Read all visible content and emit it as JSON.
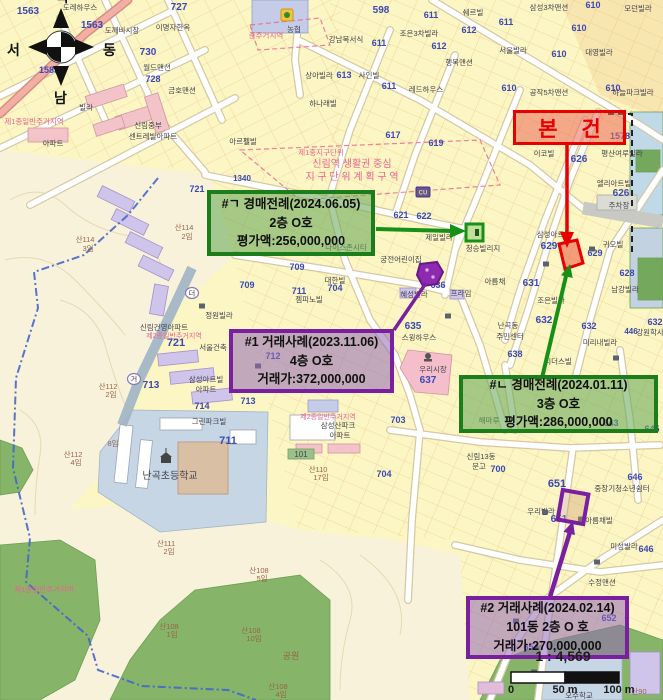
{
  "compass": {
    "north": "북",
    "south": "남",
    "west": "서",
    "east": "동"
  },
  "scale_bar": {
    "ratio_label": "1 : 4,569",
    "ticks": [
      "0",
      "50 m",
      "100 m"
    ]
  },
  "annotations": {
    "subject": {
      "label": "본 건",
      "color": "#e80000"
    },
    "auction_1": {
      "title": "#ㄱ 경매전례(2024.06.05)",
      "floor": "2층 O호",
      "value": "평가액:256,000,000",
      "color": "#1b7e1b"
    },
    "sale_1": {
      "title": "#1 거래사례(2023.11.06)",
      "floor": "4층 O호",
      "value": "거래가:372,000,000",
      "color": "#7a1fa0"
    },
    "auction_2": {
      "title": "#ㄴ 경매전례(2024.01.11)",
      "floor": "3층 O호",
      "value": "평가액:286,000,000",
      "color": "#1b7e1b"
    },
    "sale_2": {
      "title": "#2 거래사례(2024.02.14)",
      "floor": "101동 2층 O 호",
      "value": "거래가:270,000,000",
      "color": "#7a1fa0"
    }
  },
  "map": {
    "label_colors": {
      "b": "#3b49b5",
      "d": "#43434e",
      "p": "#e8638f",
      "m": "#96664a"
    },
    "labels": [
      {
        "t": "1563",
        "x": 28,
        "y": 14,
        "c": "b",
        "s": 10
      },
      {
        "t": "도레하우스",
        "x": 80,
        "y": 10,
        "c": "d"
      },
      {
        "t": "1563",
        "x": 92,
        "y": 28,
        "c": "b",
        "s": 10
      },
      {
        "t": "도깨비시장",
        "x": 122,
        "y": 33,
        "c": "d"
      },
      {
        "t": "727",
        "x": 179,
        "y": 10,
        "c": "b",
        "s": 10
      },
      {
        "t": "이명자한옥",
        "x": 173,
        "y": 30,
        "c": "d"
      },
      {
        "t": "730",
        "x": 148,
        "y": 55,
        "c": "b",
        "s": 10
      },
      {
        "t": "월드맨션",
        "x": 157,
        "y": 70,
        "c": "d"
      },
      {
        "t": "728",
        "x": 153,
        "y": 82,
        "c": "b",
        "s": 9
      },
      {
        "t": "금호맨션",
        "x": 182,
        "y": 93,
        "c": "d"
      },
      {
        "t": "1583",
        "x": 49,
        "y": 73,
        "c": "b",
        "s": 9
      },
      {
        "t": "빌라",
        "x": 86,
        "y": 110,
        "c": "d"
      },
      {
        "t": "제1종일반주거지역",
        "x": 34,
        "y": 124,
        "c": "p"
      },
      {
        "t": "신림중부",
        "x": 148,
        "y": 128,
        "c": "d"
      },
      {
        "t": "센트레빌아파트",
        "x": 153,
        "y": 139,
        "c": "d"
      },
      {
        "t": "아파트",
        "x": 53,
        "y": 146,
        "c": "d"
      },
      {
        "t": "농협",
        "x": 294,
        "y": 32,
        "c": "d"
      },
      {
        "t": "준주거지역",
        "x": 266,
        "y": 38,
        "c": "p"
      },
      {
        "t": "598",
        "x": 381,
        "y": 13,
        "c": "b",
        "s": 10
      },
      {
        "t": "611",
        "x": 431,
        "y": 18,
        "c": "b",
        "s": 9
      },
      {
        "t": "쉐르빌",
        "x": 473,
        "y": 15,
        "c": "d"
      },
      {
        "t": "삼성3차맨션",
        "x": 549,
        "y": 10,
        "c": "d"
      },
      {
        "t": "610",
        "x": 593,
        "y": 8,
        "c": "b",
        "s": 9
      },
      {
        "t": "모던빌라",
        "x": 638,
        "y": 11,
        "c": "d"
      },
      {
        "t": "강남복서식",
        "x": 346,
        "y": 42,
        "c": "d"
      },
      {
        "t": "611",
        "x": 379,
        "y": 46,
        "c": "b",
        "s": 9
      },
      {
        "t": "조은3차빌라",
        "x": 419,
        "y": 36,
        "c": "d"
      },
      {
        "t": "612",
        "x": 469,
        "y": 33,
        "c": "b",
        "s": 9
      },
      {
        "t": "611",
        "x": 506,
        "y": 25,
        "c": "b",
        "s": 9
      },
      {
        "t": "612",
        "x": 439,
        "y": 49,
        "c": "b",
        "s": 9
      },
      {
        "t": "서울빌라",
        "x": 513,
        "y": 53,
        "c": "d"
      },
      {
        "t": "610",
        "x": 579,
        "y": 31,
        "c": "b",
        "s": 9
      },
      {
        "t": "대영빌라",
        "x": 599,
        "y": 55,
        "c": "d"
      },
      {
        "t": "610",
        "x": 559,
        "y": 57,
        "c": "b",
        "s": 9
      },
      {
        "t": "행복맨션",
        "x": 459,
        "y": 65,
        "c": "d"
      },
      {
        "t": "613",
        "x": 344,
        "y": 78,
        "c": "b",
        "s": 9
      },
      {
        "t": "사인빌",
        "x": 369,
        "y": 78,
        "c": "d"
      },
      {
        "t": "상아빌라",
        "x": 319,
        "y": 78,
        "c": "d"
      },
      {
        "t": "611",
        "x": 389,
        "y": 89,
        "c": "b",
        "s": 9
      },
      {
        "t": "레드하우스",
        "x": 426,
        "y": 92,
        "c": "d"
      },
      {
        "t": "610",
        "x": 509,
        "y": 91,
        "c": "b",
        "s": 9
      },
      {
        "t": "공작5차맨션",
        "x": 549,
        "y": 95,
        "c": "d"
      },
      {
        "t": "610",
        "x": 613,
        "y": 91,
        "c": "b",
        "s": 9
      },
      {
        "t": "하늘파크빌라",
        "x": 633,
        "y": 95,
        "c": "d"
      },
      {
        "t": "하나래빌",
        "x": 323,
        "y": 106,
        "c": "d"
      },
      {
        "t": "제1종지구단위",
        "x": 321,
        "y": 155,
        "c": "p"
      },
      {
        "t": "신림역 생활권 중심",
        "x": 352,
        "y": 167,
        "c": "p",
        "s": 10
      },
      {
        "t": "지 구 단 위 계 획 구 역",
        "x": 352,
        "y": 180,
        "c": "p",
        "s": 10
      },
      {
        "t": "617",
        "x": 393,
        "y": 138,
        "c": "b",
        "s": 9
      },
      {
        "t": "619",
        "x": 436,
        "y": 146,
        "c": "b",
        "s": 9
      },
      {
        "t": "아르펠빌",
        "x": 243,
        "y": 144,
        "c": "d"
      },
      {
        "t": "1340",
        "x": 242,
        "y": 181,
        "c": "b",
        "s": 8
      },
      {
        "t": "621",
        "x": 401,
        "y": 218,
        "c": "b",
        "s": 9
      },
      {
        "t": "622",
        "x": 424,
        "y": 219,
        "c": "b",
        "s": 9
      },
      {
        "t": "제일빌라",
        "x": 439,
        "y": 240,
        "c": "d"
      },
      {
        "t": "청승빌리지",
        "x": 483,
        "y": 251,
        "c": "d"
      },
      {
        "t": "이코빌",
        "x": 544,
        "y": 156,
        "c": "d"
      },
      {
        "t": "1578",
        "x": 620,
        "y": 139,
        "c": "b",
        "s": 9
      },
      {
        "t": "평산여루빌라",
        "x": 622,
        "y": 156,
        "c": "d"
      },
      {
        "t": "626",
        "x": 579,
        "y": 162,
        "c": "b",
        "s": 10
      },
      {
        "t": "엘리아트빌",
        "x": 614,
        "y": 186,
        "c": "d"
      },
      {
        "t": "626",
        "x": 621,
        "y": 196,
        "c": "b",
        "s": 10
      },
      {
        "t": "주차장",
        "x": 619,
        "y": 208,
        "c": "d"
      },
      {
        "t": "삼성아트빌",
        "x": 554,
        "y": 237,
        "c": "d"
      },
      {
        "t": "629",
        "x": 549,
        "y": 249,
        "c": "b",
        "s": 10
      },
      {
        "t": "귀오빌",
        "x": 613,
        "y": 247,
        "c": "d"
      },
      {
        "t": "629",
        "x": 595,
        "y": 256,
        "c": "b",
        "s": 9
      },
      {
        "t": "628",
        "x": 627,
        "y": 276,
        "c": "b",
        "s": 9
      },
      {
        "t": "631",
        "x": 531,
        "y": 286,
        "c": "b",
        "s": 10
      },
      {
        "t": "남강빌라",
        "x": 625,
        "y": 292,
        "c": "d"
      },
      {
        "t": "조은빌라",
        "x": 551,
        "y": 303,
        "c": "d"
      },
      {
        "t": "632",
        "x": 544,
        "y": 323,
        "c": "b",
        "s": 10
      },
      {
        "t": "632",
        "x": 589,
        "y": 329,
        "c": "b",
        "s": 9
      },
      {
        "t": "632",
        "x": 655,
        "y": 325,
        "c": "b",
        "s": 9
      },
      {
        "t": "446",
        "x": 631,
        "y": 334,
        "c": "b",
        "s": 8
      },
      {
        "t": "강원학사",
        "x": 650,
        "y": 335,
        "c": "d"
      },
      {
        "t": "미리내빌라",
        "x": 600,
        "y": 345,
        "c": "d"
      },
      {
        "t": "리더스빌",
        "x": 558,
        "y": 364,
        "c": "d"
      },
      {
        "t": "721",
        "x": 197,
        "y": 192,
        "c": "b",
        "s": 9
      },
      {
        "t": "궁전어린이집",
        "x": 401,
        "y": 262,
        "c": "d"
      },
      {
        "t": "나이스존시티",
        "x": 346,
        "y": 250,
        "c": "d"
      },
      {
        "t": "709",
        "x": 297,
        "y": 270,
        "c": "b",
        "s": 9
      },
      {
        "t": "709",
        "x": 247,
        "y": 288,
        "c": "b",
        "s": 9
      },
      {
        "t": "711",
        "x": 299,
        "y": 294,
        "c": "b",
        "s": 9
      },
      {
        "t": "704",
        "x": 335,
        "y": 291,
        "c": "b",
        "s": 9
      },
      {
        "t": "대한빌",
        "x": 335,
        "y": 283,
        "c": "d"
      },
      {
        "t": "젬피노빌",
        "x": 309,
        "y": 302,
        "c": "d"
      },
      {
        "t": "정원빌라",
        "x": 219,
        "y": 318,
        "c": "d"
      },
      {
        "t": "신림건영아파트",
        "x": 164,
        "y": 330,
        "c": "d"
      },
      {
        "t": "제2종일반주거지역",
        "x": 174,
        "y": 338,
        "c": "p",
        "s": 7
      },
      {
        "t": "721",
        "x": 176,
        "y": 346,
        "c": "b",
        "s": 11
      },
      {
        "t": "서울건축",
        "x": 213,
        "y": 350,
        "c": "d"
      },
      {
        "t": "712",
        "x": 273,
        "y": 359,
        "c": "b",
        "s": 9
      },
      {
        "t": "삼성아트빌",
        "x": 206,
        "y": 382,
        "c": "d"
      },
      {
        "t": "아파트",
        "x": 206,
        "y": 392,
        "c": "d"
      },
      {
        "t": "713",
        "x": 151,
        "y": 388,
        "c": "b",
        "s": 10
      },
      {
        "t": "산114",
        "x": 85,
        "y": 242,
        "c": "m"
      },
      {
        "t": "3임",
        "x": 88,
        "y": 251,
        "c": "m"
      },
      {
        "t": "산114",
        "x": 184,
        "y": 230,
        "c": "m"
      },
      {
        "t": "2임",
        "x": 187,
        "y": 239,
        "c": "m"
      },
      {
        "t": "산112",
        "x": 108,
        "y": 389,
        "c": "m"
      },
      {
        "t": "2임",
        "x": 111,
        "y": 397,
        "c": "m"
      },
      {
        "t": "산112",
        "x": 73,
        "y": 457,
        "c": "m"
      },
      {
        "t": "4임",
        "x": 76,
        "y": 465,
        "c": "m"
      },
      {
        "t": "8임",
        "x": 113,
        "y": 446,
        "c": "m"
      },
      {
        "t": "714",
        "x": 202,
        "y": 409,
        "c": "b",
        "s": 9
      },
      {
        "t": "713",
        "x": 248,
        "y": 404,
        "c": "b",
        "s": 9
      },
      {
        "t": "그린파크빌",
        "x": 209,
        "y": 424,
        "c": "d"
      },
      {
        "t": "711",
        "x": 228,
        "y": 444,
        "c": "b",
        "s": 11
      },
      {
        "t": "난곡초등학교",
        "x": 170,
        "y": 479,
        "c": "d",
        "s": 10
      },
      {
        "t": "101",
        "x": 301,
        "y": 457,
        "c": "d",
        "s": 8
      },
      {
        "t": "산110",
        "x": 318,
        "y": 472,
        "c": "m"
      },
      {
        "t": "17임",
        "x": 321,
        "y": 480,
        "c": "m"
      },
      {
        "t": "제2종일반주거지역",
        "x": 328,
        "y": 419,
        "c": "p",
        "s": 7
      },
      {
        "t": "삼성산파크",
        "x": 338,
        "y": 428,
        "c": "d"
      },
      {
        "t": "아파트",
        "x": 340,
        "y": 438,
        "c": "d"
      },
      {
        "t": "703",
        "x": 398,
        "y": 423,
        "c": "b",
        "s": 9
      },
      {
        "t": "해마루",
        "x": 489,
        "y": 423,
        "c": "d"
      },
      {
        "t": "신림13동",
        "x": 481,
        "y": 459,
        "c": "d"
      },
      {
        "t": "문고",
        "x": 479,
        "y": 469,
        "c": "d"
      },
      {
        "t": "700",
        "x": 498,
        "y": 472,
        "c": "b",
        "s": 9
      },
      {
        "t": "704",
        "x": 384,
        "y": 477,
        "c": "b",
        "s": 9
      },
      {
        "t": "635",
        "x": 413,
        "y": 329,
        "c": "b",
        "s": 10
      },
      {
        "t": "스윙하우스",
        "x": 419,
        "y": 340,
        "c": "d"
      },
      {
        "t": "난곡동",
        "x": 508,
        "y": 328,
        "c": "d"
      },
      {
        "t": "주민센터",
        "x": 510,
        "y": 339,
        "c": "d"
      },
      {
        "t": "638",
        "x": 515,
        "y": 357,
        "c": "b",
        "s": 9
      },
      {
        "t": "우리시장",
        "x": 433,
        "y": 372,
        "c": "d"
      },
      {
        "t": "637",
        "x": 428,
        "y": 383,
        "c": "b",
        "s": 10
      },
      {
        "t": "636",
        "x": 438,
        "y": 288,
        "c": "b",
        "s": 9
      },
      {
        "t": "혜성빌라",
        "x": 414,
        "y": 297,
        "c": "d"
      },
      {
        "t": "프라임",
        "x": 461,
        "y": 296,
        "c": "d"
      },
      {
        "t": "아름채",
        "x": 495,
        "y": 284,
        "c": "d"
      },
      {
        "t": "643",
        "x": 611,
        "y": 426,
        "c": "b",
        "s": 9
      },
      {
        "t": "645",
        "x": 652,
        "y": 432,
        "c": "b",
        "s": 9
      },
      {
        "t": "651",
        "x": 557,
        "y": 487,
        "c": "b",
        "s": 11
      },
      {
        "t": "646",
        "x": 635,
        "y": 480,
        "c": "b",
        "s": 9
      },
      {
        "t": "중장기청소년쉼터",
        "x": 622,
        "y": 491,
        "c": "d"
      },
      {
        "t": "우리빌라",
        "x": 541,
        "y": 514,
        "c": "d"
      },
      {
        "t": "651",
        "x": 559,
        "y": 522,
        "c": "b",
        "s": 10
      },
      {
        "t": "아름채빌",
        "x": 599,
        "y": 523,
        "c": "d"
      },
      {
        "t": "미성빌라",
        "x": 624,
        "y": 549,
        "c": "d"
      },
      {
        "t": "646",
        "x": 646,
        "y": 552,
        "c": "b",
        "s": 9
      },
      {
        "t": "수정맨션",
        "x": 602,
        "y": 585,
        "c": "d"
      },
      {
        "t": "652",
        "x": 609,
        "y": 621,
        "c": "b",
        "s": 9
      },
      {
        "t": "654",
        "x": 531,
        "y": 650,
        "c": "b",
        "s": 9
      },
      {
        "t": "산90",
        "x": 639,
        "y": 694,
        "c": "m"
      },
      {
        "t": "오주학교",
        "x": 579,
        "y": 698,
        "c": "d"
      },
      {
        "t": "산111",
        "x": 166,
        "y": 546,
        "c": "m"
      },
      {
        "t": "2임",
        "x": 169,
        "y": 554,
        "c": "m"
      },
      {
        "t": "산108",
        "x": 259,
        "y": 573,
        "c": "m"
      },
      {
        "t": "5임",
        "x": 262,
        "y": 581,
        "c": "m"
      },
      {
        "t": "제1종일반주거지역",
        "x": 44,
        "y": 592,
        "c": "p"
      },
      {
        "t": "산108",
        "x": 169,
        "y": 629,
        "c": "m"
      },
      {
        "t": "1임",
        "x": 172,
        "y": 637,
        "c": "m"
      },
      {
        "t": "산108",
        "x": 251,
        "y": 633,
        "c": "m"
      },
      {
        "t": "10임",
        "x": 254,
        "y": 641,
        "c": "m"
      },
      {
        "t": "공원",
        "x": 291,
        "y": 659,
        "c": "m",
        "s": 9
      },
      {
        "t": "산108",
        "x": 278,
        "y": 689,
        "c": "m"
      },
      {
        "t": "4임",
        "x": 281,
        "y": 697,
        "c": "m"
      }
    ],
    "icons": [
      {
        "n": "nh-mart",
        "x": 287,
        "y": 15
      },
      {
        "n": "cu-store",
        "t": "CU",
        "x": 423,
        "y": 192
      },
      {
        "n": "school",
        "x": 166,
        "y": 458
      },
      {
        "n": "market",
        "x": 428,
        "y": 358
      },
      {
        "n": "building",
        "x": 546,
        "y": 264
      },
      {
        "n": "building",
        "x": 592,
        "y": 249
      },
      {
        "n": "building",
        "x": 616,
        "y": 358
      },
      {
        "n": "building",
        "x": 545,
        "y": 512
      },
      {
        "n": "building",
        "x": 581,
        "y": 519
      },
      {
        "n": "building",
        "x": 597,
        "y": 562
      },
      {
        "n": "building",
        "x": 516,
        "y": 621
      },
      {
        "n": "building",
        "x": 202,
        "y": 306
      },
      {
        "n": "building",
        "x": 258,
        "y": 366
      },
      {
        "n": "building",
        "x": 448,
        "y": 316
      },
      {
        "n": "building",
        "x": 534,
        "y": 672
      },
      {
        "n": "road-badge",
        "t": "더",
        "x": 192,
        "y": 293
      },
      {
        "n": "road-badge",
        "t": "거",
        "x": 134,
        "y": 379
      }
    ]
  }
}
